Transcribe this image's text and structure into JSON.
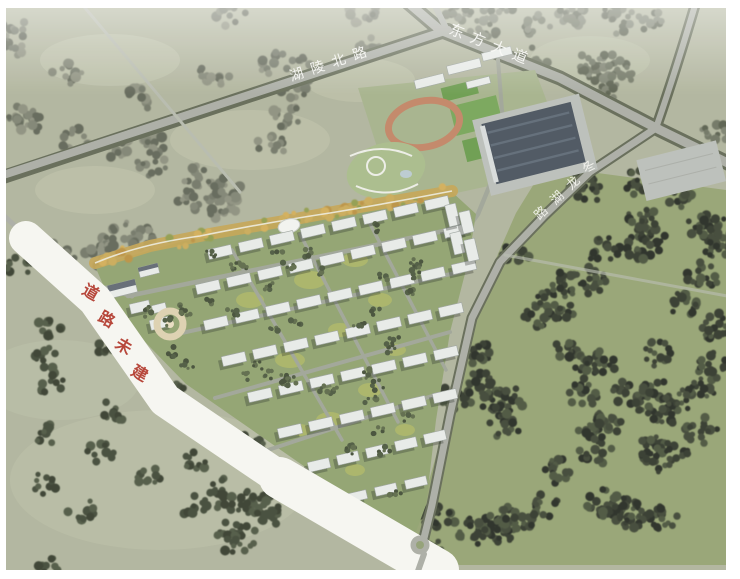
{
  "labels": {
    "north_road": {
      "text": "湖陵北路",
      "color": "rgba(250,250,247,0.92)"
    },
    "east_avenue": {
      "text": "东方大道",
      "color": "rgba(250,250,247,0.92)"
    },
    "lake_road": {
      "text": "冬龙湖路",
      "color": "rgba(248,248,244,0.88)"
    },
    "unbuilt_road": {
      "text": "道路未建",
      "color": "#b23a2e"
    }
  },
  "palette": {
    "fieldBase": "#aeb29b",
    "fieldPale": "#bcc1a9",
    "forestGround": "#93a170",
    "road": "#a8aba3",
    "roadTree": "#5f6652",
    "lane": "#b4b8ac",
    "siteRoad": "#9da295",
    "whiteRoad": "#f6f6f1",
    "campus": "#a3b089",
    "pitch": "#7ca75e",
    "track": "#c08262",
    "court": "#67994a",
    "court2": "#74a356",
    "slab": "#e7eae8",
    "slabEdge": "#99a09c",
    "roofDark": "#454f5b",
    "roofLight": "#5b6774",
    "pad": "#b9bdb8",
    "siteGround": "#8da06c",
    "belt": "#c2a24f",
    "shadow": "rgba(30,36,30,0.32)"
  },
  "scene": {
    "labels_layout": {
      "north_road": {
        "layer": "lbl-north",
        "size": 14,
        "rot": -18,
        "weight": "normal",
        "pos": [
          [
            298,
            79
          ],
          [
            319,
            72
          ],
          [
            340,
            65
          ],
          [
            361,
            58
          ]
        ]
      },
      "east_avenue": {
        "layer": "lbl-east",
        "size": 15,
        "rot": 22,
        "weight": "normal",
        "pos": [
          [
            455,
            36
          ],
          [
            476,
            44
          ],
          [
            497,
            53
          ],
          [
            518,
            61
          ]
        ]
      },
      "lake_road": {
        "layer": "lbl-lake",
        "size": 13,
        "rot": -44,
        "weight": "normal",
        "pos": [
          [
            592,
            170
          ],
          [
            576,
            186
          ],
          [
            560,
            201
          ],
          [
            544,
            216
          ]
        ]
      },
      "unbuilt_road": {
        "layer": "lbl-unbuilt",
        "size": 16,
        "rot": 30,
        "weight": "bold",
        "pos": [
          [
            88,
            297
          ],
          [
            104,
            324
          ],
          [
            121,
            351
          ],
          [
            137,
            378
          ]
        ]
      }
    },
    "forest_regions": [
      {
        "layer": "layer-forest-under",
        "seed": 7,
        "clusters": 30,
        "blobs": 12,
        "clusterR": 16,
        "rmin": 2.5,
        "rmax": 5.5,
        "colors": [
          "#6f7465",
          "#7c8070",
          "#5d6254",
          "#8a8d7c"
        ],
        "poly": [
          [
            6,
            8
          ],
          [
            420,
            8
          ],
          [
            400,
            40
          ],
          [
            300,
            110
          ],
          [
            240,
            200
          ],
          [
            150,
            250
          ],
          [
            60,
            262
          ],
          [
            6,
            240
          ]
        ]
      },
      {
        "layer": "layer-forest-under",
        "seed": 11,
        "clusters": 16,
        "blobs": 12,
        "clusterR": 15,
        "rmin": 2.5,
        "rmax": 5.0,
        "colors": [
          "#6c7260",
          "#7a7f6e",
          "#565c4b"
        ],
        "poly": [
          [
            430,
            8
          ],
          [
            726,
            8
          ],
          [
            726,
            150
          ],
          [
            660,
            120
          ],
          [
            560,
            70
          ],
          [
            470,
            30
          ]
        ]
      },
      {
        "layer": "layer-forest-under",
        "seed": 3,
        "clusters": 60,
        "blobs": 16,
        "clusterR": 17,
        "rmin": 2.4,
        "rmax": 5.0,
        "colors": [
          "#2e3428",
          "#3b4232",
          "#222720",
          "#46503a"
        ],
        "poly": [
          [
            545,
            168
          ],
          [
            726,
            192
          ],
          [
            726,
            565
          ],
          [
            408,
            565
          ],
          [
            420,
            515
          ],
          [
            448,
            415
          ],
          [
            472,
            315
          ],
          [
            515,
            215
          ]
        ]
      },
      {
        "layer": "layer-forest-under",
        "seed": 21,
        "clusters": 26,
        "blobs": 10,
        "clusterR": 14,
        "rmin": 2.5,
        "rmax": 5.0,
        "colors": [
          "#3d4534",
          "#4b5440",
          "#333a2b"
        ],
        "poly": [
          [
            6,
            268
          ],
          [
            40,
            252
          ],
          [
            140,
            350
          ],
          [
            260,
            452
          ],
          [
            390,
            545
          ],
          [
            380,
            571
          ],
          [
            6,
            571
          ]
        ]
      },
      {
        "layer": "layer-site-trees",
        "seed": 5,
        "clusters": 45,
        "blobs": 5,
        "clusterR": 7,
        "rmin": 1.5,
        "rmax": 3.2,
        "colors": [
          "#49553c",
          "#3f4a33",
          "#5a6746"
        ],
        "poly": [
          [
            120,
            290
          ],
          [
            200,
            255
          ],
          [
            300,
            232
          ],
          [
            420,
            210
          ],
          [
            455,
            225
          ],
          [
            440,
            330
          ],
          [
            425,
            430
          ],
          [
            415,
            520
          ],
          [
            300,
            460
          ],
          [
            190,
            380
          ]
        ]
      }
    ],
    "belt": {
      "pts": [
        [
          95,
          263
        ],
        [
          150,
          246
        ],
        [
          215,
          233
        ],
        [
          290,
          220
        ],
        [
          360,
          207
        ],
        [
          418,
          197
        ],
        [
          452,
          191
        ]
      ],
      "count": 55,
      "spread": 7,
      "rmin": 2,
      "rmax": 4.5,
      "seed": 9,
      "colors": [
        "#d1ac55",
        "#b98f3f",
        "#8e9a4b",
        "#c9a855"
      ]
    },
    "lawns": [
      [
        250,
        300,
        14,
        8
      ],
      [
        310,
        280,
        16,
        9
      ],
      [
        355,
        260,
        13,
        7
      ],
      [
        290,
        360,
        15,
        8
      ],
      [
        340,
        330,
        12,
        7
      ],
      [
        380,
        300,
        12,
        7
      ],
      [
        330,
        420,
        14,
        8
      ],
      [
        370,
        390,
        12,
        7
      ],
      [
        300,
        430,
        10,
        6
      ],
      [
        395,
        350,
        11,
        6
      ],
      [
        405,
        430,
        10,
        6
      ],
      [
        355,
        470,
        10,
        6
      ]
    ],
    "lawnColor": "#b4ba60",
    "building_rows": [
      {
        "x": 208,
        "y": 247,
        "dx": 31,
        "dy": -7,
        "n": 8,
        "w": 24,
        "h": 10
      },
      {
        "x": 196,
        "y": 282,
        "dx": 31,
        "dy": -7,
        "n": 9,
        "w": 24,
        "h": 10
      },
      {
        "x": 204,
        "y": 318,
        "dx": 31,
        "dy": -7,
        "n": 9,
        "w": 24,
        "h": 10
      },
      {
        "x": 222,
        "y": 354,
        "dx": 31,
        "dy": -7,
        "n": 8,
        "w": 24,
        "h": 10
      },
      {
        "x": 248,
        "y": 390,
        "dx": 31,
        "dy": -7,
        "n": 7,
        "w": 24,
        "h": 10
      },
      {
        "x": 278,
        "y": 426,
        "dx": 31,
        "dy": -7,
        "n": 6,
        "w": 24,
        "h": 10
      },
      {
        "x": 308,
        "y": 460,
        "dx": 29,
        "dy": -7,
        "n": 5,
        "w": 22,
        "h": 10
      },
      {
        "x": 345,
        "y": 492,
        "dx": 30,
        "dy": -7,
        "n": 3,
        "w": 22,
        "h": 9
      }
    ],
    "extra_buildings": [
      [
        447,
        204,
        11,
        22
      ],
      [
        461,
        211,
        11,
        22
      ],
      [
        452,
        232,
        11,
        22
      ],
      [
        466,
        239,
        11,
        22
      ],
      [
        150,
        318,
        22,
        10
      ],
      [
        130,
        302,
        20,
        10
      ]
    ],
    "building_rot": -13
  }
}
